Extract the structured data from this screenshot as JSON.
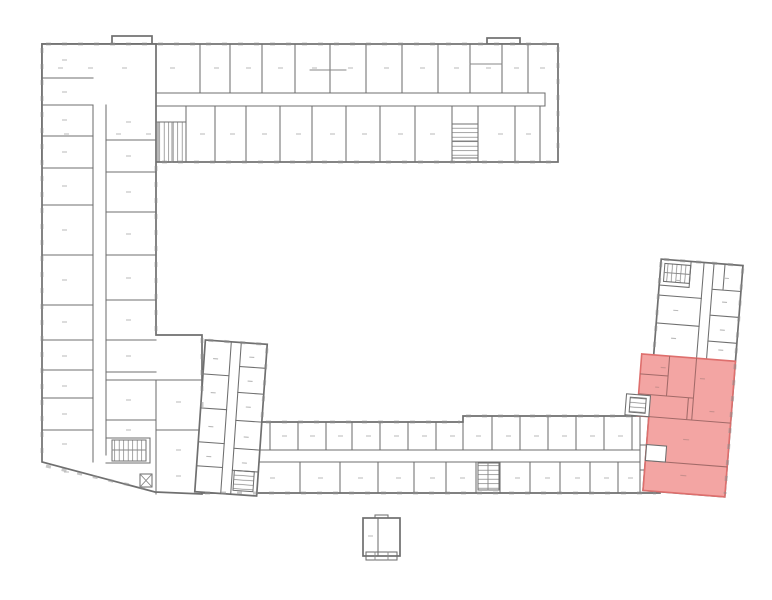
{
  "page": {
    "background": "#ffffff",
    "content_type": "architectural-floor-plan",
    "visible_text": []
  },
  "colors": {
    "wall": "#6f6f6f",
    "wall_interior": "#878787",
    "window": "#8f8f8f",
    "label_dash": "#b9b9b9",
    "stair": "#7d7d7d",
    "highlight_fill": "#f3a5a3",
    "highlight_stroke": "#de6f6d",
    "highlight_wall": "#a26a68",
    "highlight_label": "#c98f8d"
  },
  "plan": {
    "wings": [
      {
        "id": "north-wing",
        "orientation": "horizontal"
      },
      {
        "id": "west-wing",
        "orientation": "vertical"
      },
      {
        "id": "south-wing",
        "orientation": "horizontal"
      },
      {
        "id": "central-annex",
        "tilted": true
      },
      {
        "id": "east-wing",
        "tilted": true
      },
      {
        "id": "outbuilding",
        "detached": true
      }
    ],
    "courtyard": {
      "id": "courtyard",
      "enclosed": true
    },
    "stairwell_count": 7,
    "highlighted_unit": {
      "wing": "east-wing",
      "state": "selected"
    }
  }
}
